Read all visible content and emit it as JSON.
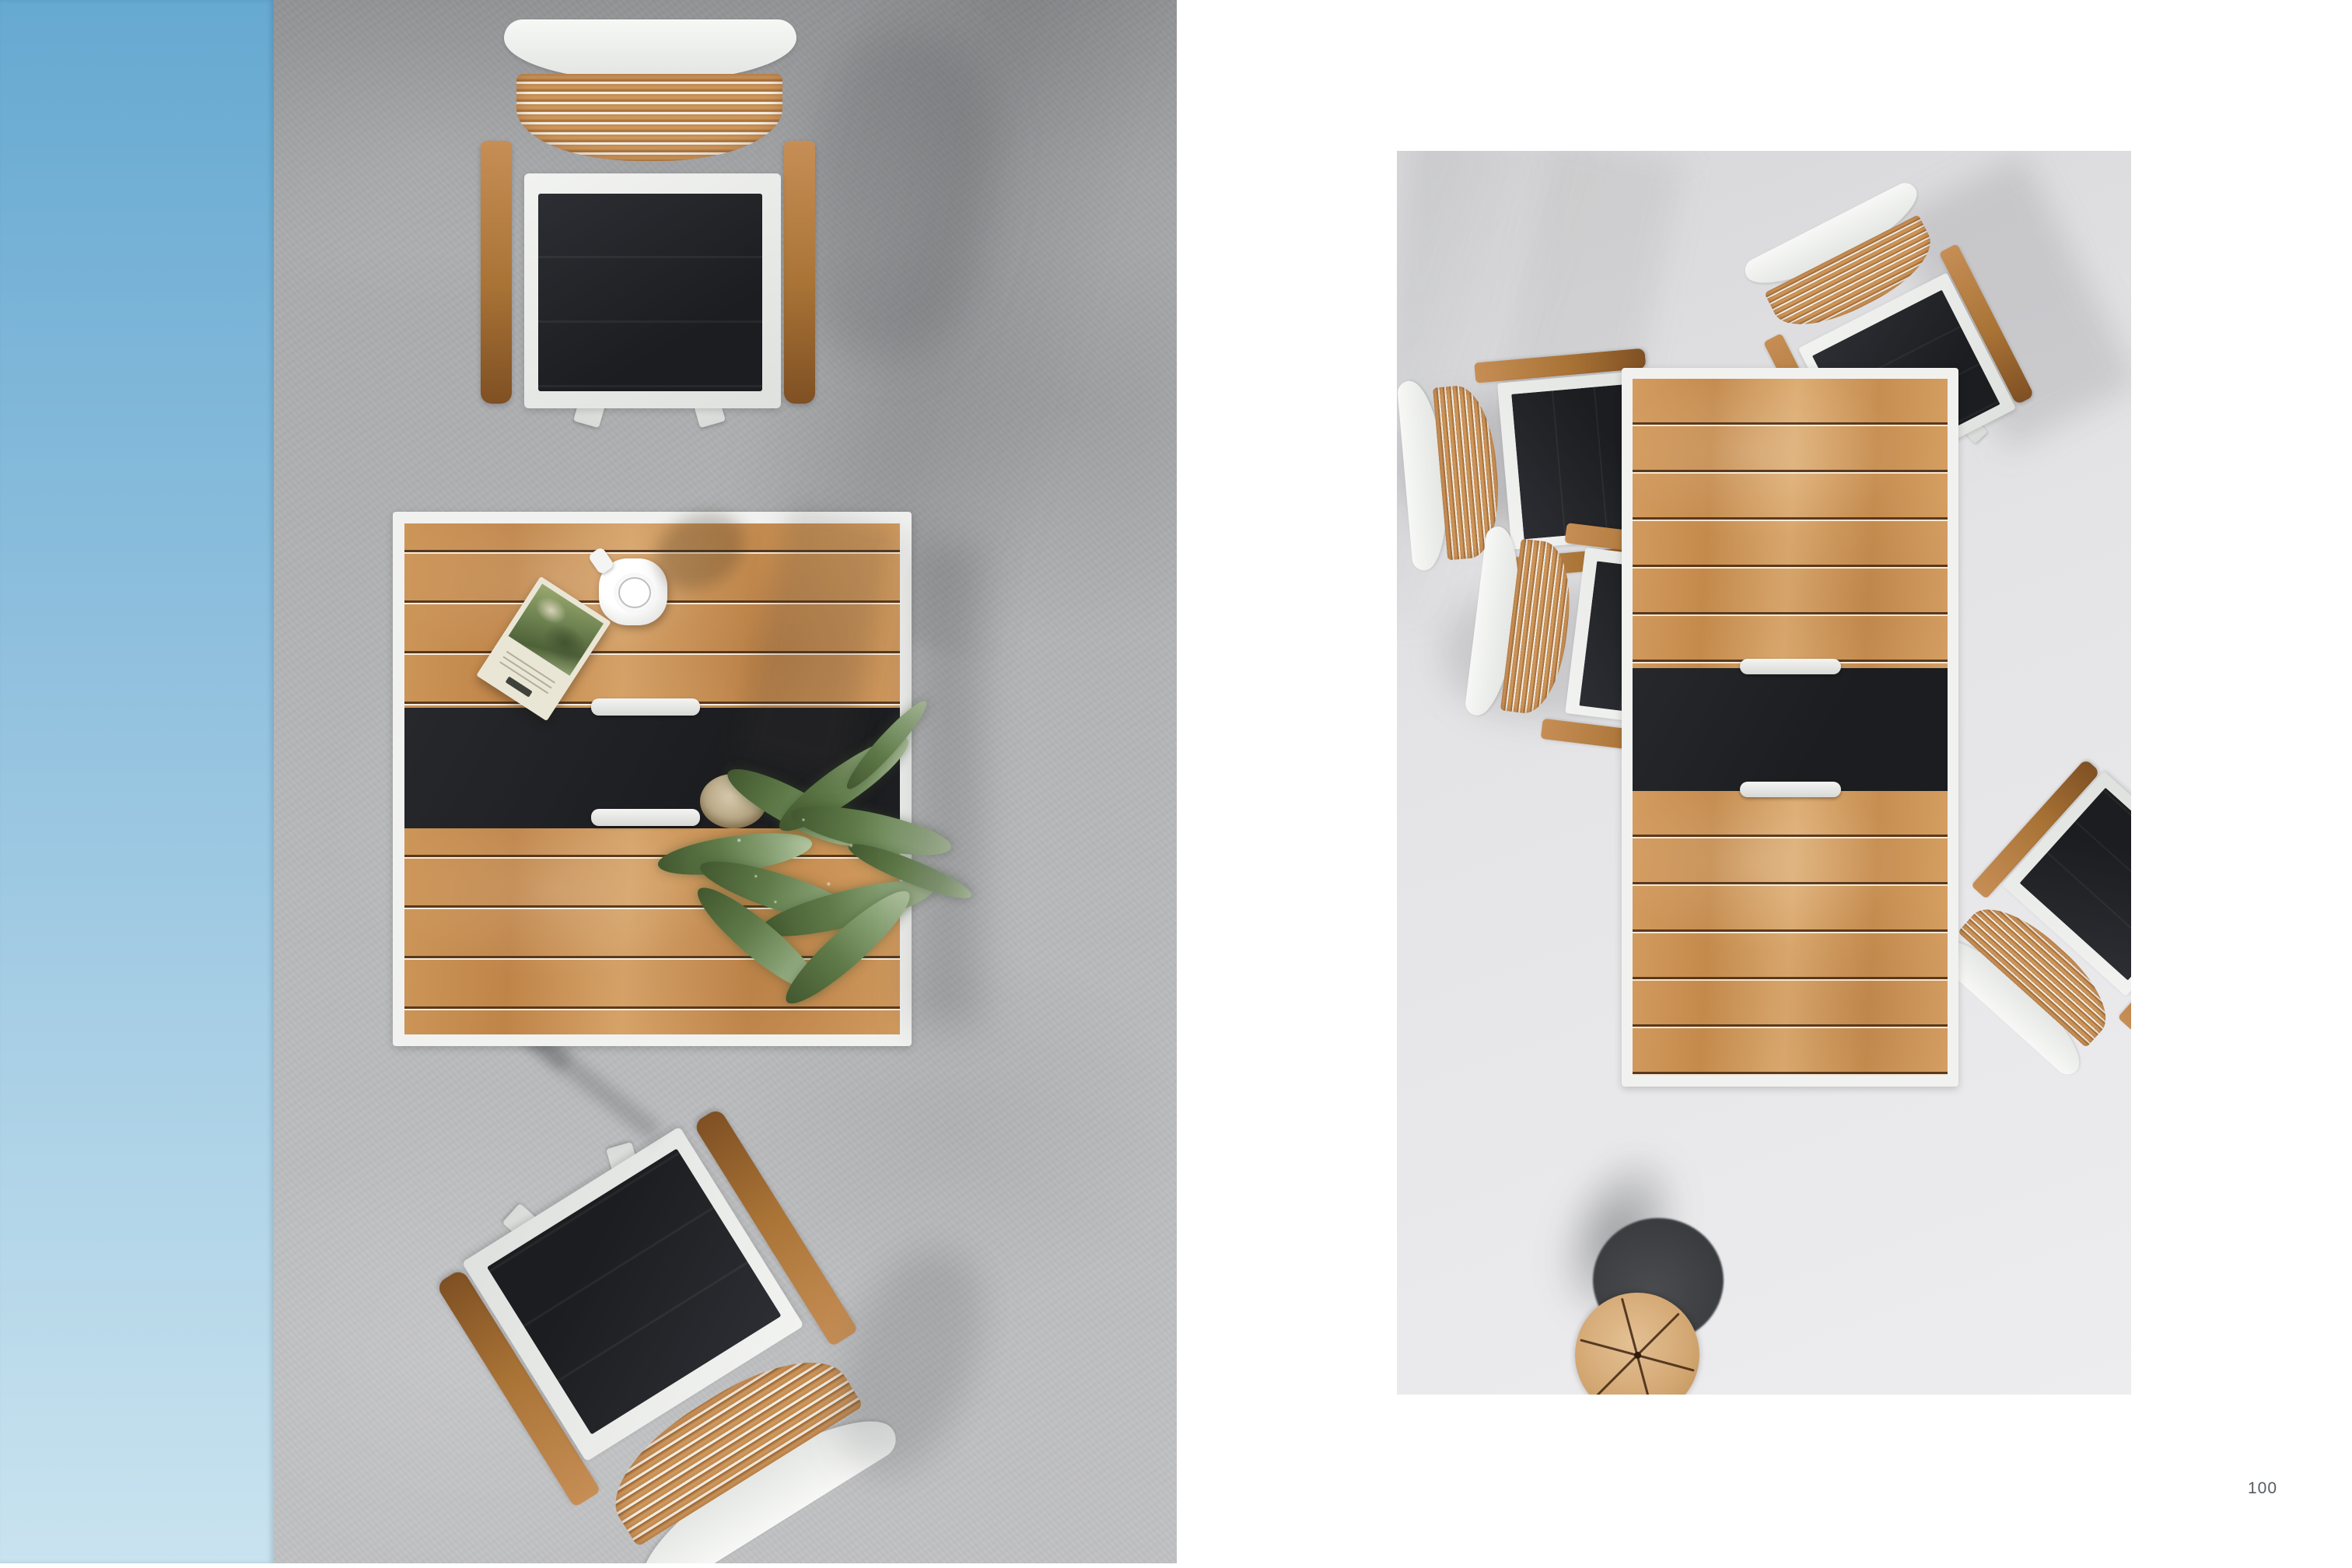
{
  "page": {
    "number": "100"
  },
  "spread": {
    "left_page": {
      "kind": "full-bleed-overhead-photo",
      "objects": [
        "blue-wall-strip",
        "concrete-floor",
        "teak-armchair-top",
        "square-teak-dining-table",
        "coffee-cup-on-saucer",
        "botanical-booklet",
        "potted-fern",
        "teak-armchair-bottom-rotated"
      ]
    },
    "right_page": {
      "kind": "inset-overhead-photo-on-white-page",
      "objects": [
        "rectangular-teak-dining-table",
        "armchair-top-right-tilted",
        "armchair-left-upper",
        "armchair-left-lower",
        "armchair-bottom-right-rotated",
        "round-teak-stool-with-pie-cuts"
      ]
    }
  },
  "theme": {
    "colors": {
      "page-bg": "#ffffff",
      "blue-top": "#66a9d1",
      "blue-mid": "#93c2df",
      "blue-bottom": "#c9e3ef",
      "concrete": "#b3b4b6",
      "wood": "#c99157",
      "slat-wood": "#c28a50",
      "slat-gap": "#f2ede3",
      "arm-wood": "#a97336",
      "frame-white": "#f1f2f0",
      "sling-black": "#1c1d20",
      "handle": "#d8d9d7",
      "right-bg": "#e4e4e6",
      "right-bg-dark": "#d7d7d9",
      "right-bg-light": "#ededef",
      "stool-wood": "#d2a671",
      "stool-base": "#3a3c3f",
      "fern-dark": "#42572f",
      "fern-light": "#8aa377",
      "book-cream": "#eae6d6",
      "coffee": "#17120e",
      "page-number": "#565b62"
    }
  }
}
